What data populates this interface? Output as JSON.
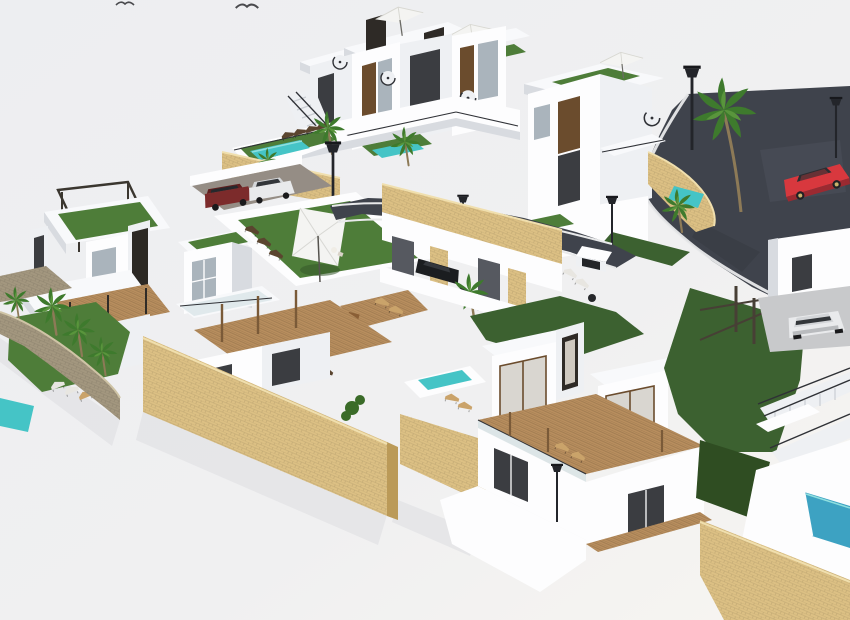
{
  "scene": {
    "kind": "architectural-3d-render",
    "view": "aerial-oblique",
    "subject": "hillside villa development with white modern villas, roof terraces, swimming pools, palm trees, sandstone retaining walls and a curved asphalt road",
    "counts": {
      "birds": 2,
      "swimming_pools": 6,
      "street_lamps": 6,
      "cars": 5,
      "parasols": 4,
      "spiral_staircases": 4
    },
    "cars": [
      "red coupe driving on road (upper right)",
      "dark red SUV parked (center left)",
      "white car parked (center left)",
      "black car in carport (center)",
      "white car parked on driveway (right)"
    ]
  },
  "palette": {
    "bg_top": "#edeef1",
    "bg_bottom": "#f7f5f2",
    "white_lit": "#fdfdfe",
    "white_mid": "#eef0f3",
    "white_shade": "#d8dbe0",
    "white_dark": "#bfc3ca",
    "white_roof": "#f8f9fb",
    "turf_green": "#4e7d39",
    "turf_dark": "#3c6029",
    "lawn_green": "#3c6130",
    "lawn_dark": "#2f4d22",
    "pool_teal": "#45c4c6",
    "pool_light": "#8fdfdf",
    "pool_blue": "#3da2c2",
    "stone_sand": "#dcc084",
    "stone_sand_light": "#f0dfae",
    "stone_sand_dark": "#bb9a58",
    "stone_gray": "#a3977f",
    "deck_wood": "#b88e5e",
    "deck_wood_dark": "#94703f",
    "window_glass": "#aab4bc",
    "window_dark": "#3b3d41",
    "panel_brown": "#6b4c2d",
    "frame_dark": "#2e2a26",
    "road_asphalt": "#3f434c",
    "road_light": "#4d525c",
    "curb_white": "#e8e9ea",
    "car_red": "#d8383e",
    "car_red_dark": "#a4272e",
    "car_white": "#e9eaec",
    "suv_maroon": "#7c2b2b",
    "car_black": "#1b1d20",
    "metal_dark": "#2f3136",
    "parasol_white": "#f4f4f2",
    "shadow": "#d9dade",
    "palm_green": "#3e7a2d",
    "palm_green_light": "#59953c",
    "trunk_brown": "#8d7a57"
  }
}
